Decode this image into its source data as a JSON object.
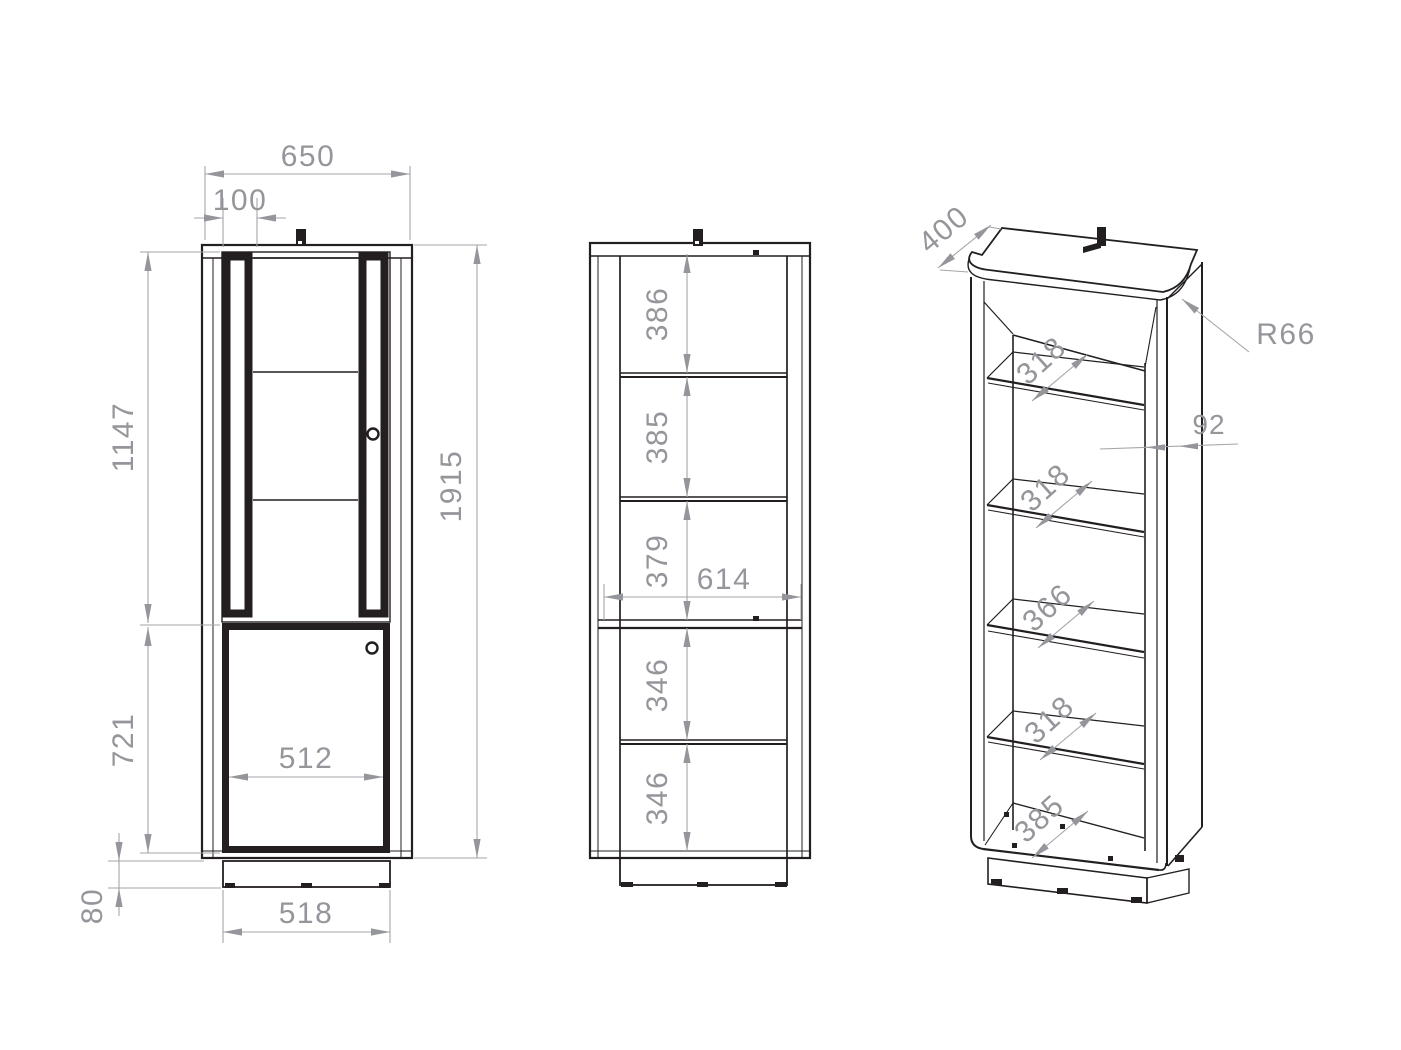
{
  "views": {
    "front": {
      "dims": {
        "overall_width": "650",
        "frame_strip_width": "100",
        "upper_section_height": "1147",
        "lower_section_height": "721",
        "overall_height": "1915",
        "door_opening_width": "512",
        "base_width": "518",
        "base_height": "80"
      }
    },
    "internal": {
      "dims": {
        "section_1": "386",
        "section_2": "385",
        "section_3": "379",
        "inner_width": "614",
        "section_4": "346",
        "section_5": "346"
      }
    },
    "perspective": {
      "dims": {
        "depth": "400",
        "corner_radius": "R66",
        "stile_width": "92",
        "shelf_1_depth": "318",
        "shelf_2_depth": "318",
        "divider_depth": "366",
        "shelf_3_depth": "318",
        "bottom_depth": "385"
      }
    }
  },
  "colors": {
    "line": "#231f20",
    "dimension": "#94969b",
    "background": "#ffffff"
  }
}
